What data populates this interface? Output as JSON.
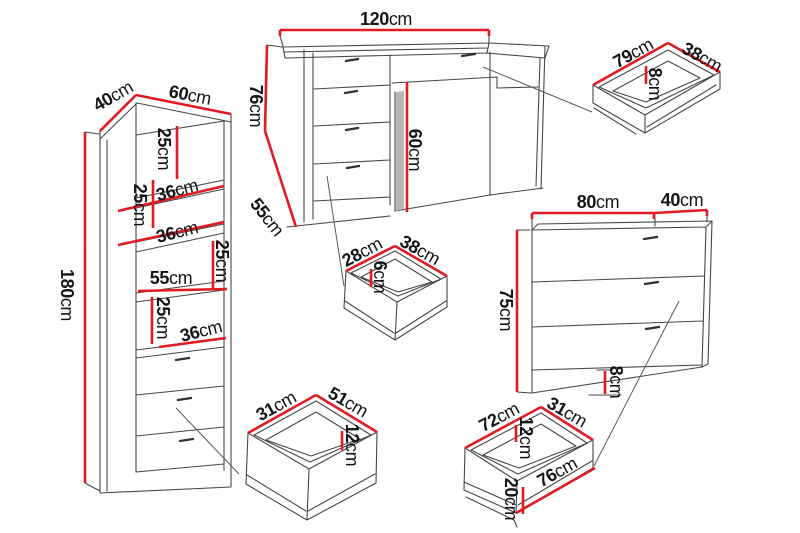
{
  "colors": {
    "dimension_red": "#e01b21",
    "outline": "#474747",
    "leader": "#5a5a5a",
    "text": "#151515",
    "background": "#ffffff"
  },
  "wardrobe": {
    "depth": {
      "value": "40",
      "unit": "cm"
    },
    "width": {
      "value": "60",
      "unit": "cm"
    },
    "height": {
      "value": "180",
      "unit": "cm"
    },
    "gap1": {
      "value": "25",
      "unit": "cm"
    },
    "shelf1": {
      "value": "36",
      "unit": "cm"
    },
    "gap2": {
      "value": "25",
      "unit": "cm"
    },
    "shelf2": {
      "value": "36",
      "unit": "cm"
    },
    "gap3": {
      "value": "25",
      "unit": "cm"
    },
    "interior_width": {
      "value": "55",
      "unit": "cm"
    },
    "gap4": {
      "value": "25",
      "unit": "cm"
    },
    "shelf3": {
      "value": "36",
      "unit": "cm"
    }
  },
  "desk": {
    "width": {
      "value": "120",
      "unit": "cm"
    },
    "height": {
      "value": "76",
      "unit": "cm"
    },
    "depth": {
      "value": "55",
      "unit": "cm"
    },
    "knee_height": {
      "value": "60",
      "unit": "cm"
    }
  },
  "desk_drawer": {
    "width": {
      "value": "79",
      "unit": "cm"
    },
    "depth": {
      "value": "38",
      "unit": "cm"
    },
    "height": {
      "value": "8",
      "unit": "cm"
    }
  },
  "small_drawer": {
    "width": {
      "value": "28",
      "unit": "cm"
    },
    "depth": {
      "value": "38",
      "unit": "cm"
    },
    "height": {
      "value": "6",
      "unit": "cm"
    }
  },
  "chest": {
    "width": {
      "value": "80",
      "unit": "cm"
    },
    "depth": {
      "value": "40",
      "unit": "cm"
    },
    "height": {
      "value": "75",
      "unit": "cm"
    },
    "plinth_height": {
      "value": "8",
      "unit": "cm"
    }
  },
  "wardrobe_drawer": {
    "width": {
      "value": "31",
      "unit": "cm"
    },
    "depth": {
      "value": "51",
      "unit": "cm"
    },
    "height": {
      "value": "12",
      "unit": "cm"
    }
  },
  "chest_drawer": {
    "width": {
      "value": "72",
      "unit": "cm"
    },
    "depth": {
      "value": "31",
      "unit": "cm"
    },
    "inner_height": {
      "value": "12",
      "unit": "cm"
    },
    "front_height": {
      "value": "20",
      "unit": "cm"
    },
    "front_width": {
      "value": "76",
      "unit": "cm"
    }
  }
}
